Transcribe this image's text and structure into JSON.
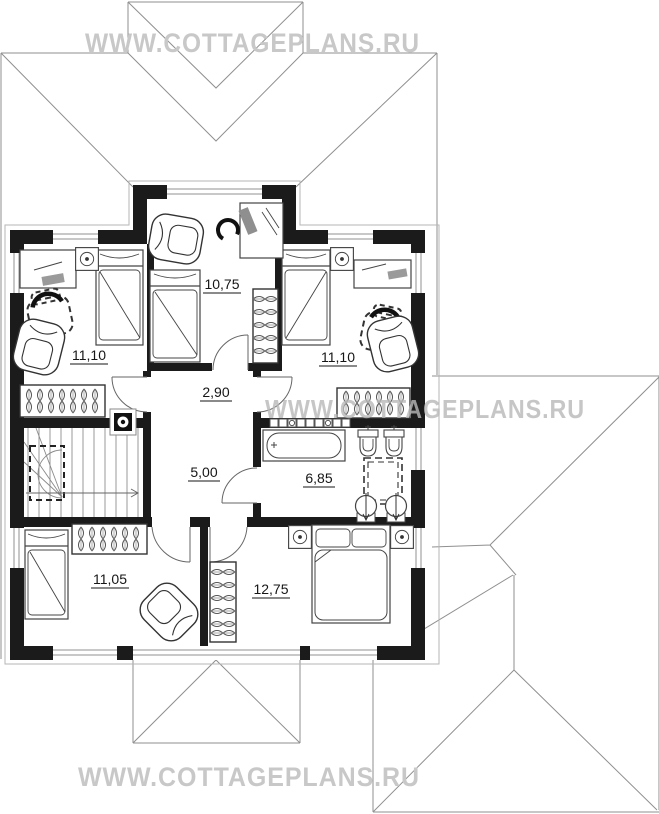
{
  "watermark": {
    "text": "WWW.COTTAGEPLANS.RU"
  },
  "plan": {
    "rooms": [
      {
        "name": "study-dormer-room",
        "area_label": "10,75"
      },
      {
        "name": "bedroom-left",
        "area_label": "11,10"
      },
      {
        "name": "bedroom-right",
        "area_label": "11,10"
      },
      {
        "name": "corridor",
        "area_label": "2,90"
      },
      {
        "name": "stair-hall",
        "area_label": "5,00"
      },
      {
        "name": "bathroom",
        "area_label": "6,85"
      },
      {
        "name": "bedroom-lower-left",
        "area_label": "11,05"
      },
      {
        "name": "master-bedroom",
        "area_label": "12,75"
      }
    ]
  },
  "colors": {
    "wall": "#1b1b1b",
    "roof_line": "#8f8f8f",
    "watermark": "#c6c6c6",
    "furniture_line": "#444444"
  }
}
